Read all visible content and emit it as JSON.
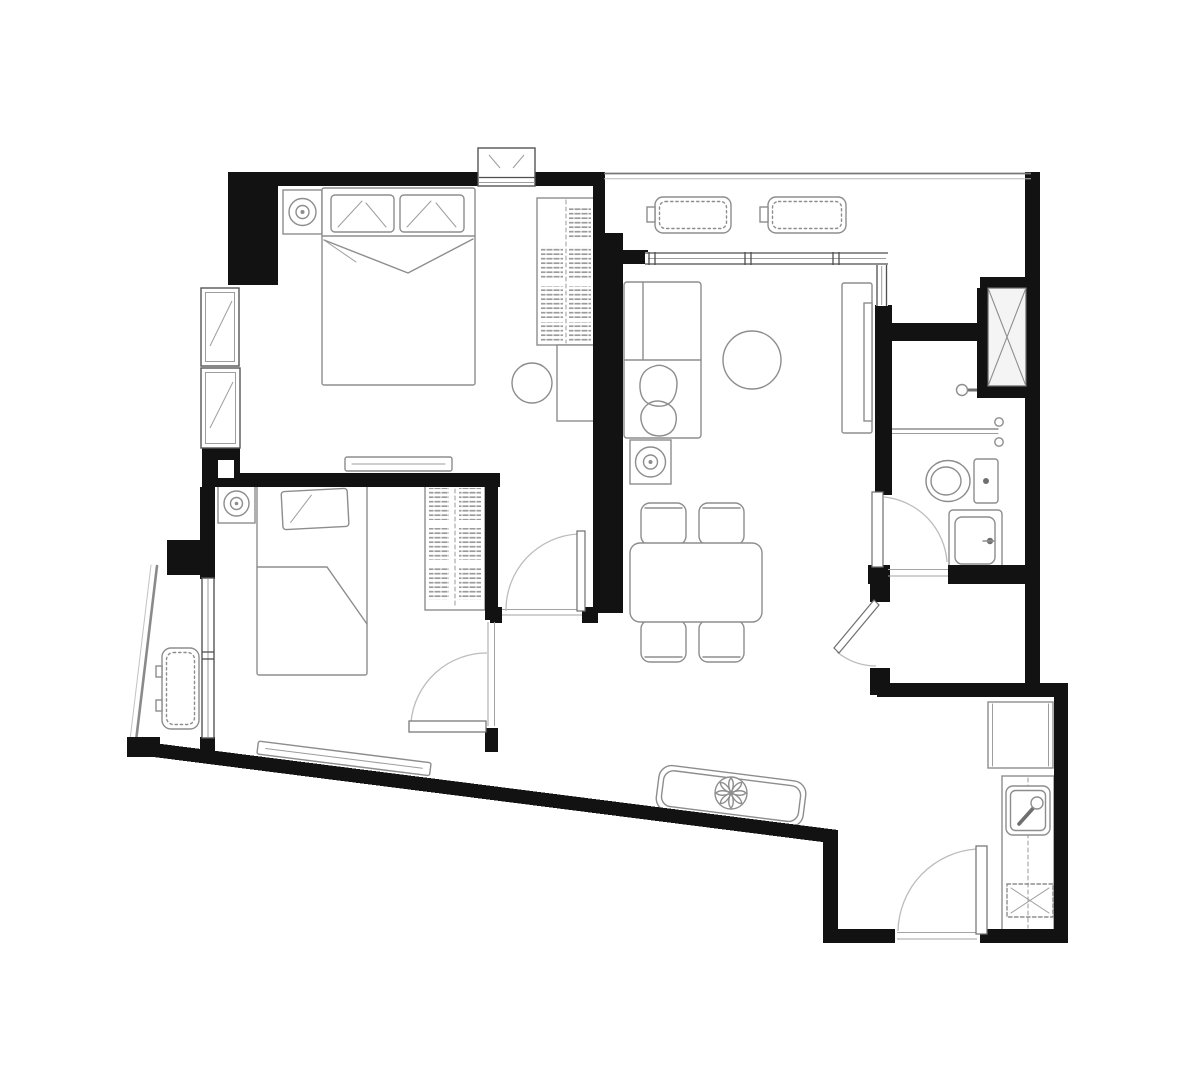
{
  "document": {
    "type": "architectural-floor-plan",
    "description": "Black-and-white top-view floor plan of a two-bedroom, one-bathroom apartment unit with living-dining hall, open kitchen entry, service shaft, AC ledge and a small balcony. No text labels or dimensions are printed on the drawing.",
    "visible_text": []
  },
  "colors": {
    "wall": "#121212",
    "furniture_stroke": "#8d8d8d",
    "window_stroke": "#4e4e4e",
    "door_arc": "#bcbcbc",
    "hatch": "#9b9b9b",
    "background": "#ffffff"
  },
  "rooms": [
    {
      "id": "master-bedroom",
      "fixtures": [
        "double-bed",
        "pillow-left",
        "pillow-right",
        "nightstand-with-lamp",
        "wardrobe",
        "dresser-desk",
        "stool",
        "tv-console",
        "vent-window-box",
        "casement-window-upper",
        "casement-window-lower",
        "swing-door"
      ]
    },
    {
      "id": "bedroom-2",
      "fixtures": [
        "single-bed",
        "pillow",
        "nightstand-with-lamp",
        "wardrobe",
        "tv-console",
        "balcony-window",
        "swing-door"
      ]
    },
    {
      "id": "living-dining",
      "fixtures": [
        "l-shaped-sofa",
        "throw-blanket",
        "round-coffee-table",
        "side-table-with-lamp",
        "tv-console",
        "tv",
        "dining-table",
        "dining-chair-1",
        "dining-chair-2",
        "dining-chair-3",
        "dining-chair-4",
        "window-wall"
      ]
    },
    {
      "id": "ac-ledge",
      "fixtures": [
        "condenser-unit-1",
        "condenser-unit-2"
      ]
    },
    {
      "id": "balcony",
      "fixtures": [
        "condenser-unit",
        "glass-parapet"
      ]
    },
    {
      "id": "bathroom",
      "fixtures": [
        "service-shaft",
        "shower-head",
        "glass-partition",
        "partition-knobs",
        "toilet",
        "vanity-sink",
        "swing-door"
      ]
    },
    {
      "id": "entry-hall",
      "fixtures": [
        "sideboard",
        "flower-decor",
        "angled-swing-door"
      ]
    },
    {
      "id": "kitchen-entry",
      "fixtures": [
        "refrigerator",
        "counter",
        "kitchen-sink",
        "hob",
        "entrance-door"
      ]
    }
  ]
}
